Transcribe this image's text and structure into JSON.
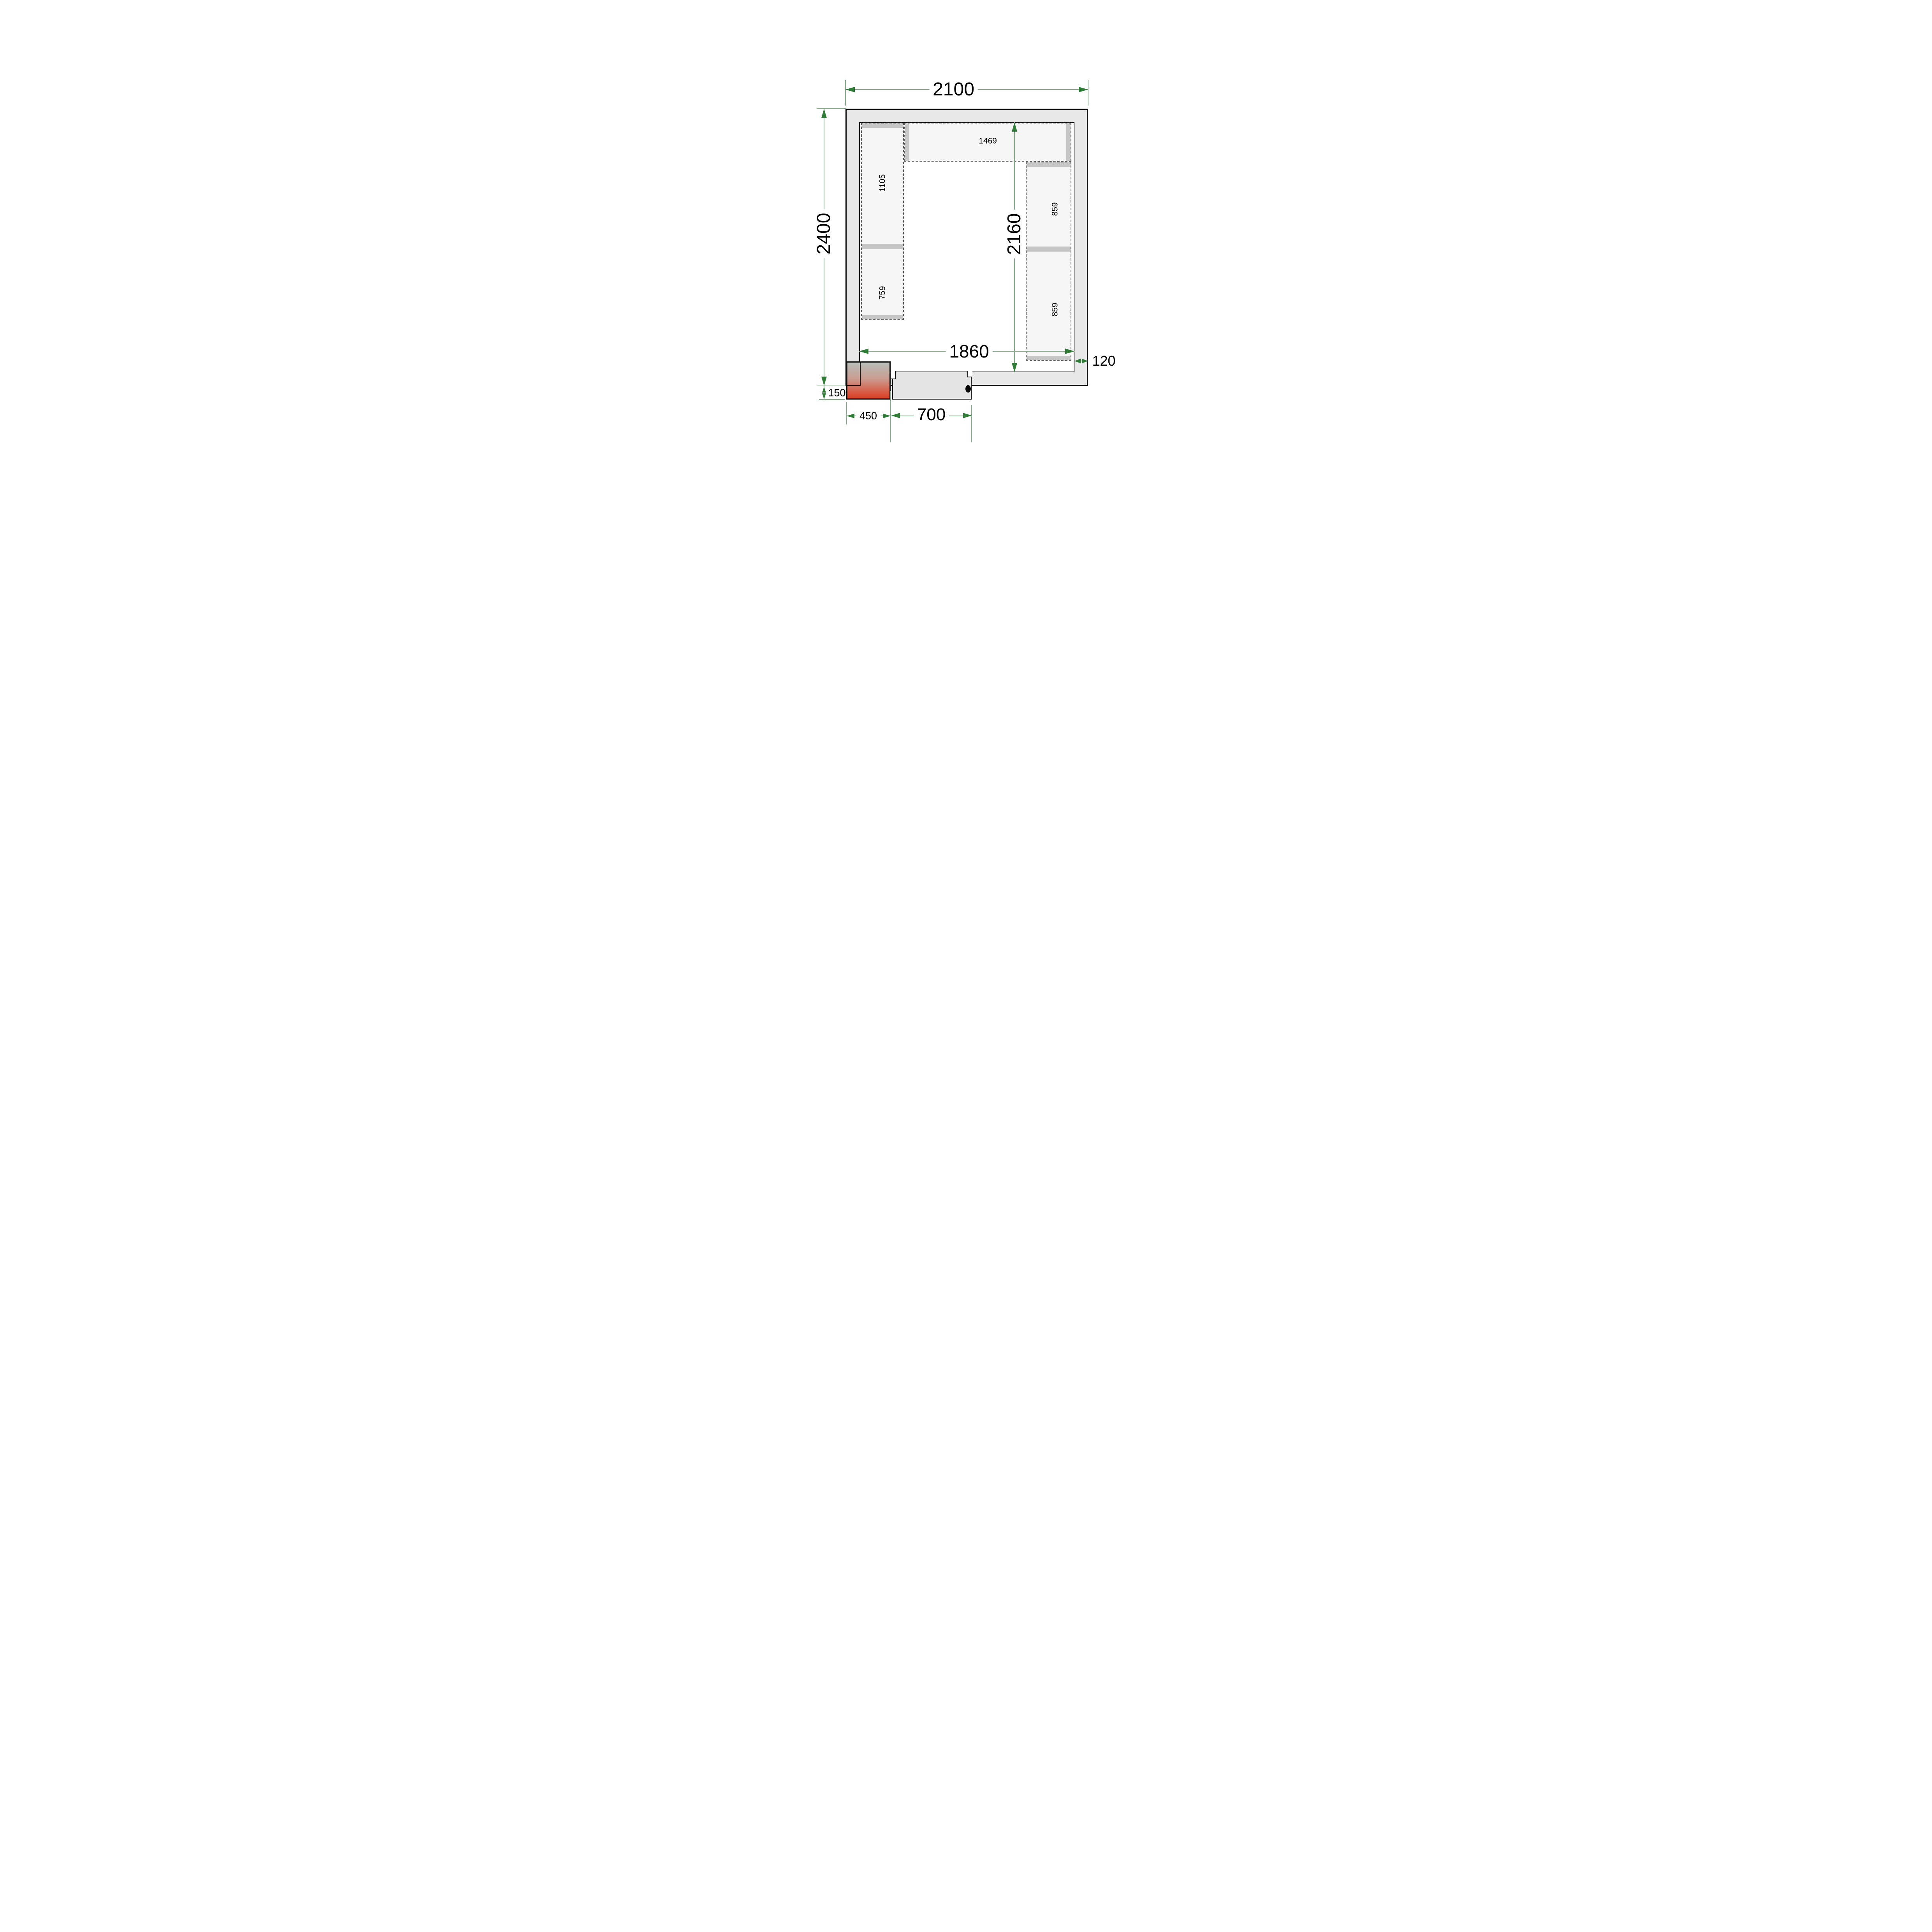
{
  "drawing": {
    "type": "cold-room floor plan, top view",
    "colors": {
      "wall_fill": "#e8e8e8",
      "shelf_fill": "#f5f5f5",
      "bar_fill": "#c6c6c6",
      "dim_line": "#84ab88",
      "dim_arrow": "#2f7c37",
      "outline": "#111111",
      "door_fill": "#e4e4e4",
      "condenser_top": "#b7bfba",
      "condenser_mid": "#c99c90",
      "condenser_bottom": "#da4a31"
    },
    "dimensions": {
      "outer_width": {
        "value": "2100"
      },
      "outer_height": {
        "value": "2400"
      },
      "inner_width": {
        "value": "1860"
      },
      "inner_height": {
        "value": "2160"
      },
      "wall_thickness": {
        "value": "120"
      },
      "unit_protrusion": {
        "value": "150"
      },
      "unit_width": {
        "value": "450"
      },
      "door_width": {
        "value": "700"
      }
    },
    "shelves": {
      "left": {
        "sections": [
          {
            "label": "1105"
          },
          {
            "label": "759"
          }
        ]
      },
      "top": {
        "sections": [
          {
            "label": "1469"
          }
        ]
      },
      "right": {
        "sections": [
          {
            "label": "859"
          },
          {
            "label": "859"
          }
        ]
      }
    }
  }
}
